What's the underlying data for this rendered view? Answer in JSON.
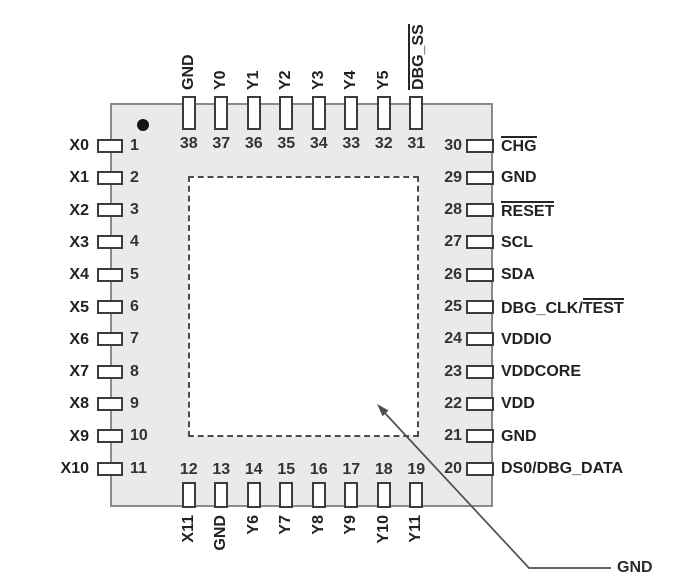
{
  "diagram_type": "ic-package-pinout-top-view",
  "pin1_marker": "filled-dot",
  "callout": {
    "label": "GND",
    "points_to": "center-pad"
  },
  "colors": {
    "package_fill": "#e9eaeb",
    "line": "#2b2b2b"
  },
  "pins": {
    "top": [
      {
        "number": "38",
        "parts": [
          {
            "text": "GND",
            "overline": false
          }
        ]
      },
      {
        "number": "37",
        "parts": [
          {
            "text": "Y0",
            "overline": false
          }
        ]
      },
      {
        "number": "36",
        "parts": [
          {
            "text": "Y1",
            "overline": false
          }
        ]
      },
      {
        "number": "35",
        "parts": [
          {
            "text": "Y2",
            "overline": false
          }
        ]
      },
      {
        "number": "34",
        "parts": [
          {
            "text": "Y3",
            "overline": false
          }
        ]
      },
      {
        "number": "33",
        "parts": [
          {
            "text": "Y4",
            "overline": false
          }
        ]
      },
      {
        "number": "32",
        "parts": [
          {
            "text": "Y5",
            "overline": false
          }
        ]
      },
      {
        "number": "31",
        "parts": [
          {
            "text": "DBG_SS",
            "overline": true
          }
        ]
      }
    ],
    "left": [
      {
        "number": "1",
        "parts": [
          {
            "text": "X0",
            "overline": false
          }
        ]
      },
      {
        "number": "2",
        "parts": [
          {
            "text": "X1",
            "overline": false
          }
        ]
      },
      {
        "number": "3",
        "parts": [
          {
            "text": "X2",
            "overline": false
          }
        ]
      },
      {
        "number": "4",
        "parts": [
          {
            "text": "X3",
            "overline": false
          }
        ]
      },
      {
        "number": "5",
        "parts": [
          {
            "text": "X4",
            "overline": false
          }
        ]
      },
      {
        "number": "6",
        "parts": [
          {
            "text": "X5",
            "overline": false
          }
        ]
      },
      {
        "number": "7",
        "parts": [
          {
            "text": "X6",
            "overline": false
          }
        ]
      },
      {
        "number": "8",
        "parts": [
          {
            "text": "X7",
            "overline": false
          }
        ]
      },
      {
        "number": "9",
        "parts": [
          {
            "text": "X8",
            "overline": false
          }
        ]
      },
      {
        "number": "10",
        "parts": [
          {
            "text": "X9",
            "overline": false
          }
        ]
      },
      {
        "number": "11",
        "parts": [
          {
            "text": "X10",
            "overline": false
          }
        ]
      }
    ],
    "right": [
      {
        "number": "30",
        "parts": [
          {
            "text": "CHG",
            "overline": true
          }
        ]
      },
      {
        "number": "29",
        "parts": [
          {
            "text": "GND",
            "overline": false
          }
        ]
      },
      {
        "number": "28",
        "parts": [
          {
            "text": "RESET",
            "overline": true
          }
        ]
      },
      {
        "number": "27",
        "parts": [
          {
            "text": "SCL",
            "overline": false
          }
        ]
      },
      {
        "number": "26",
        "parts": [
          {
            "text": "SDA",
            "overline": false
          }
        ]
      },
      {
        "number": "25",
        "parts": [
          {
            "text": "DBG_CLK/",
            "overline": false
          },
          {
            "text": "TEST",
            "overline": true
          }
        ]
      },
      {
        "number": "24",
        "parts": [
          {
            "text": "VDDIO",
            "overline": false
          }
        ]
      },
      {
        "number": "23",
        "parts": [
          {
            "text": "VDDCORE",
            "overline": false
          }
        ]
      },
      {
        "number": "22",
        "parts": [
          {
            "text": "VDD",
            "overline": false
          }
        ]
      },
      {
        "number": "21",
        "parts": [
          {
            "text": "GND",
            "overline": false
          }
        ]
      },
      {
        "number": "20",
        "parts": [
          {
            "text": "DS0/DBG_DATA",
            "overline": false
          }
        ]
      }
    ],
    "bottom": [
      {
        "number": "12",
        "parts": [
          {
            "text": "X11",
            "overline": false
          }
        ]
      },
      {
        "number": "13",
        "parts": [
          {
            "text": "GND",
            "overline": false
          }
        ]
      },
      {
        "number": "14",
        "parts": [
          {
            "text": "Y6",
            "overline": false
          }
        ]
      },
      {
        "number": "15",
        "parts": [
          {
            "text": "Y7",
            "overline": false
          }
        ]
      },
      {
        "number": "16",
        "parts": [
          {
            "text": "Y8",
            "overline": false
          }
        ]
      },
      {
        "number": "17",
        "parts": [
          {
            "text": "Y9",
            "overline": false
          }
        ]
      },
      {
        "number": "18",
        "parts": [
          {
            "text": "Y10",
            "overline": false
          }
        ]
      },
      {
        "number": "19",
        "parts": [
          {
            "text": "Y11",
            "overline": false
          }
        ]
      }
    ]
  }
}
